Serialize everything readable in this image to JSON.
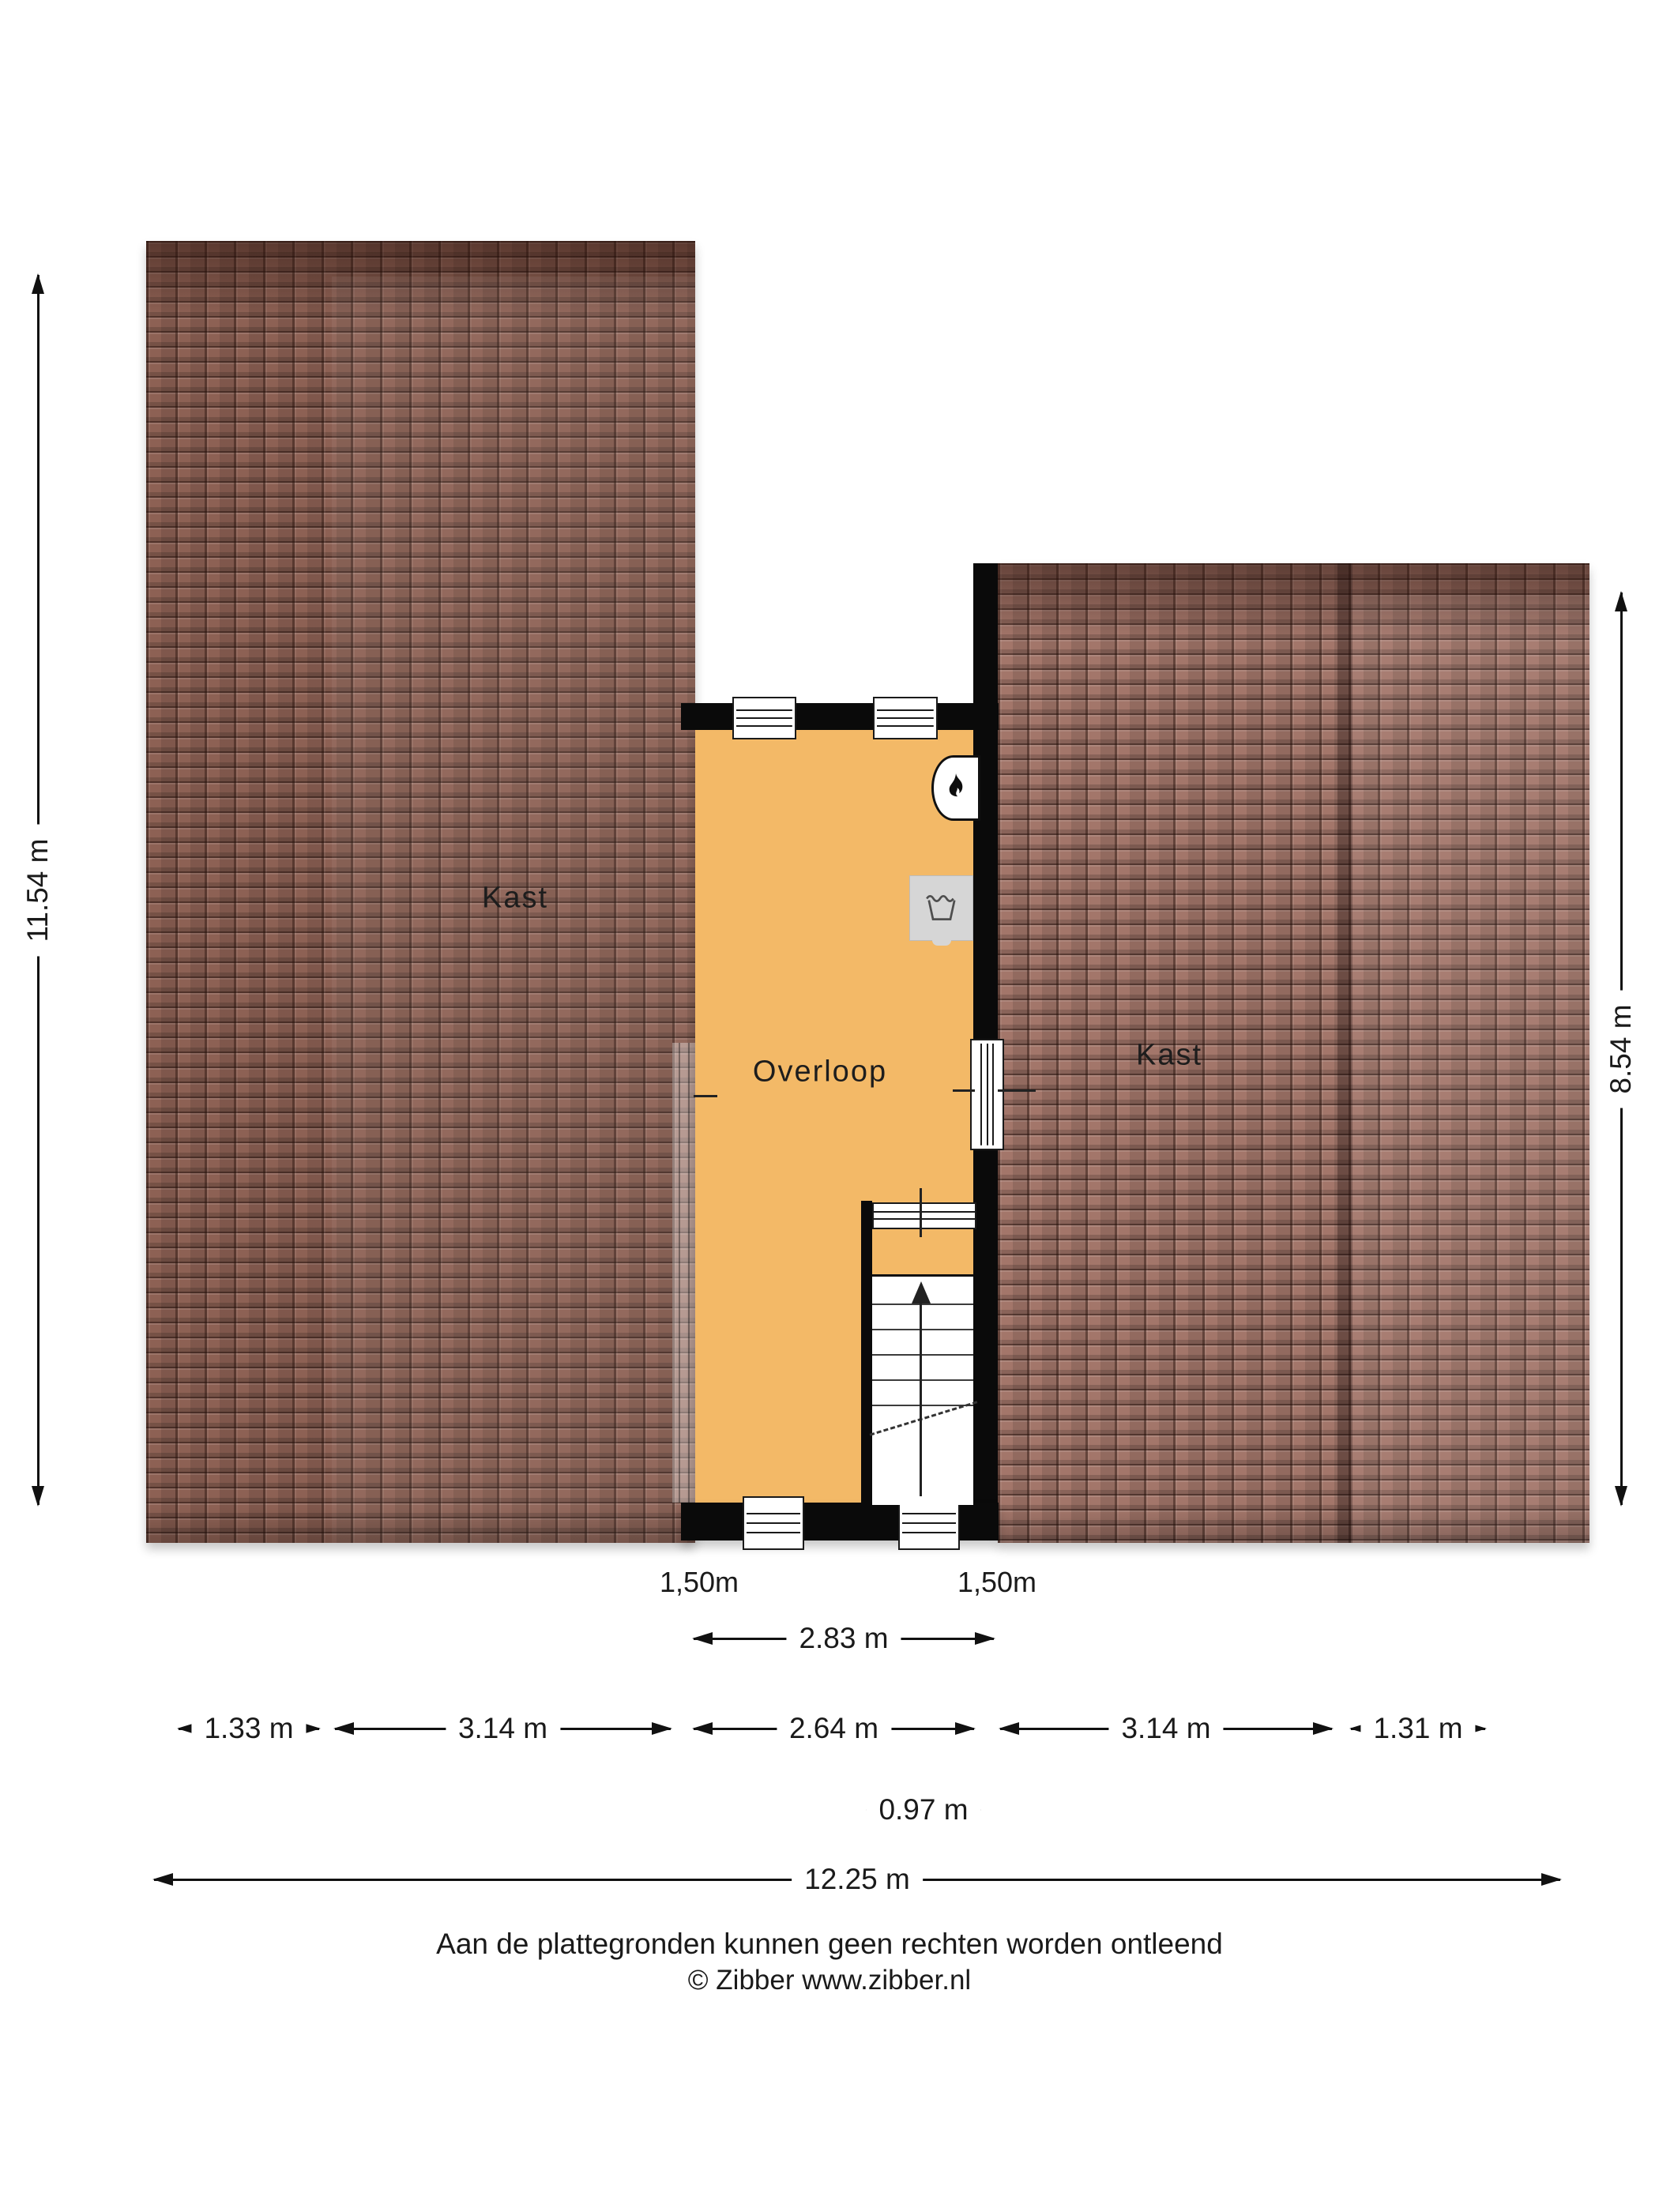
{
  "colors": {
    "floor_orange": "#f3b967",
    "roof_left": "#8d6154",
    "roof_right": "#a3766a",
    "wall": "#0a0a0a"
  },
  "rooms": {
    "kast_left": "Kast",
    "overloop": "Overloop",
    "kast_right": "Kast"
  },
  "icons": {
    "boiler": "flame-icon",
    "washer": "washing-machine-icon"
  },
  "dimensions": {
    "left_height": "11.54 m",
    "right_height": "8.54 m",
    "clearance_left": "1,50m",
    "clearance_right": "1,50m",
    "landing_width": "2.83 m",
    "segments": [
      "1.33 m",
      "3.14 m",
      "2.64 m",
      "3.14 m",
      "1.31 m"
    ],
    "stair_width": "0.97 m",
    "total_width": "12.25 m"
  },
  "footer": {
    "disclaimer": "Aan de plattegronden kunnen geen rechten worden ontleend",
    "copyright": "© Zibber www.zibber.nl"
  }
}
